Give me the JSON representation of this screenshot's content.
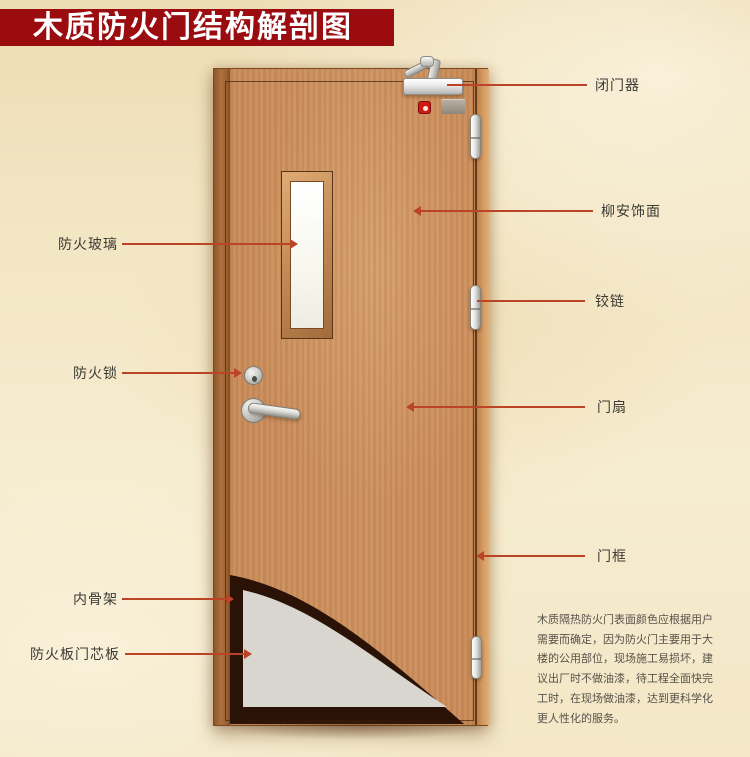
{
  "title": {
    "text": "木质防火门结构解剖图"
  },
  "labels": {
    "left": [
      {
        "id": "fire-glass",
        "text": "防火玻璃"
      },
      {
        "id": "fire-lock",
        "text": "防火锁"
      },
      {
        "id": "inner-skeleton",
        "text": "内骨架"
      },
      {
        "id": "fire-board-core",
        "text": "防火板门芯板"
      }
    ],
    "right": [
      {
        "id": "door-closer",
        "text": "闭门器"
      },
      {
        "id": "lauan-veneer",
        "text": "柳安饰面"
      },
      {
        "id": "hinge",
        "text": "铰链"
      },
      {
        "id": "door-leaf",
        "text": "门扇"
      },
      {
        "id": "door-frame",
        "text": "门框"
      }
    ]
  },
  "description": {
    "lines": [
      "木质隔热防火门表面颜色应根据用户",
      "需要而确定，因为防火门主要用于大",
      "楼的公用部位，现场施工易损坏，建",
      "议出厂时不做油漆，待工程全面快完",
      "工时，在现场做油漆，达到更科学化",
      "更人性化的服务。"
    ]
  },
  "colors": {
    "banner_red": "#9a0c10",
    "leader_red": "#bb4326",
    "door_wood": "#c88a58",
    "core_gray": "#d8d6ce",
    "skeleton_dark": "#2a1206",
    "background": "#f2e5c2"
  }
}
